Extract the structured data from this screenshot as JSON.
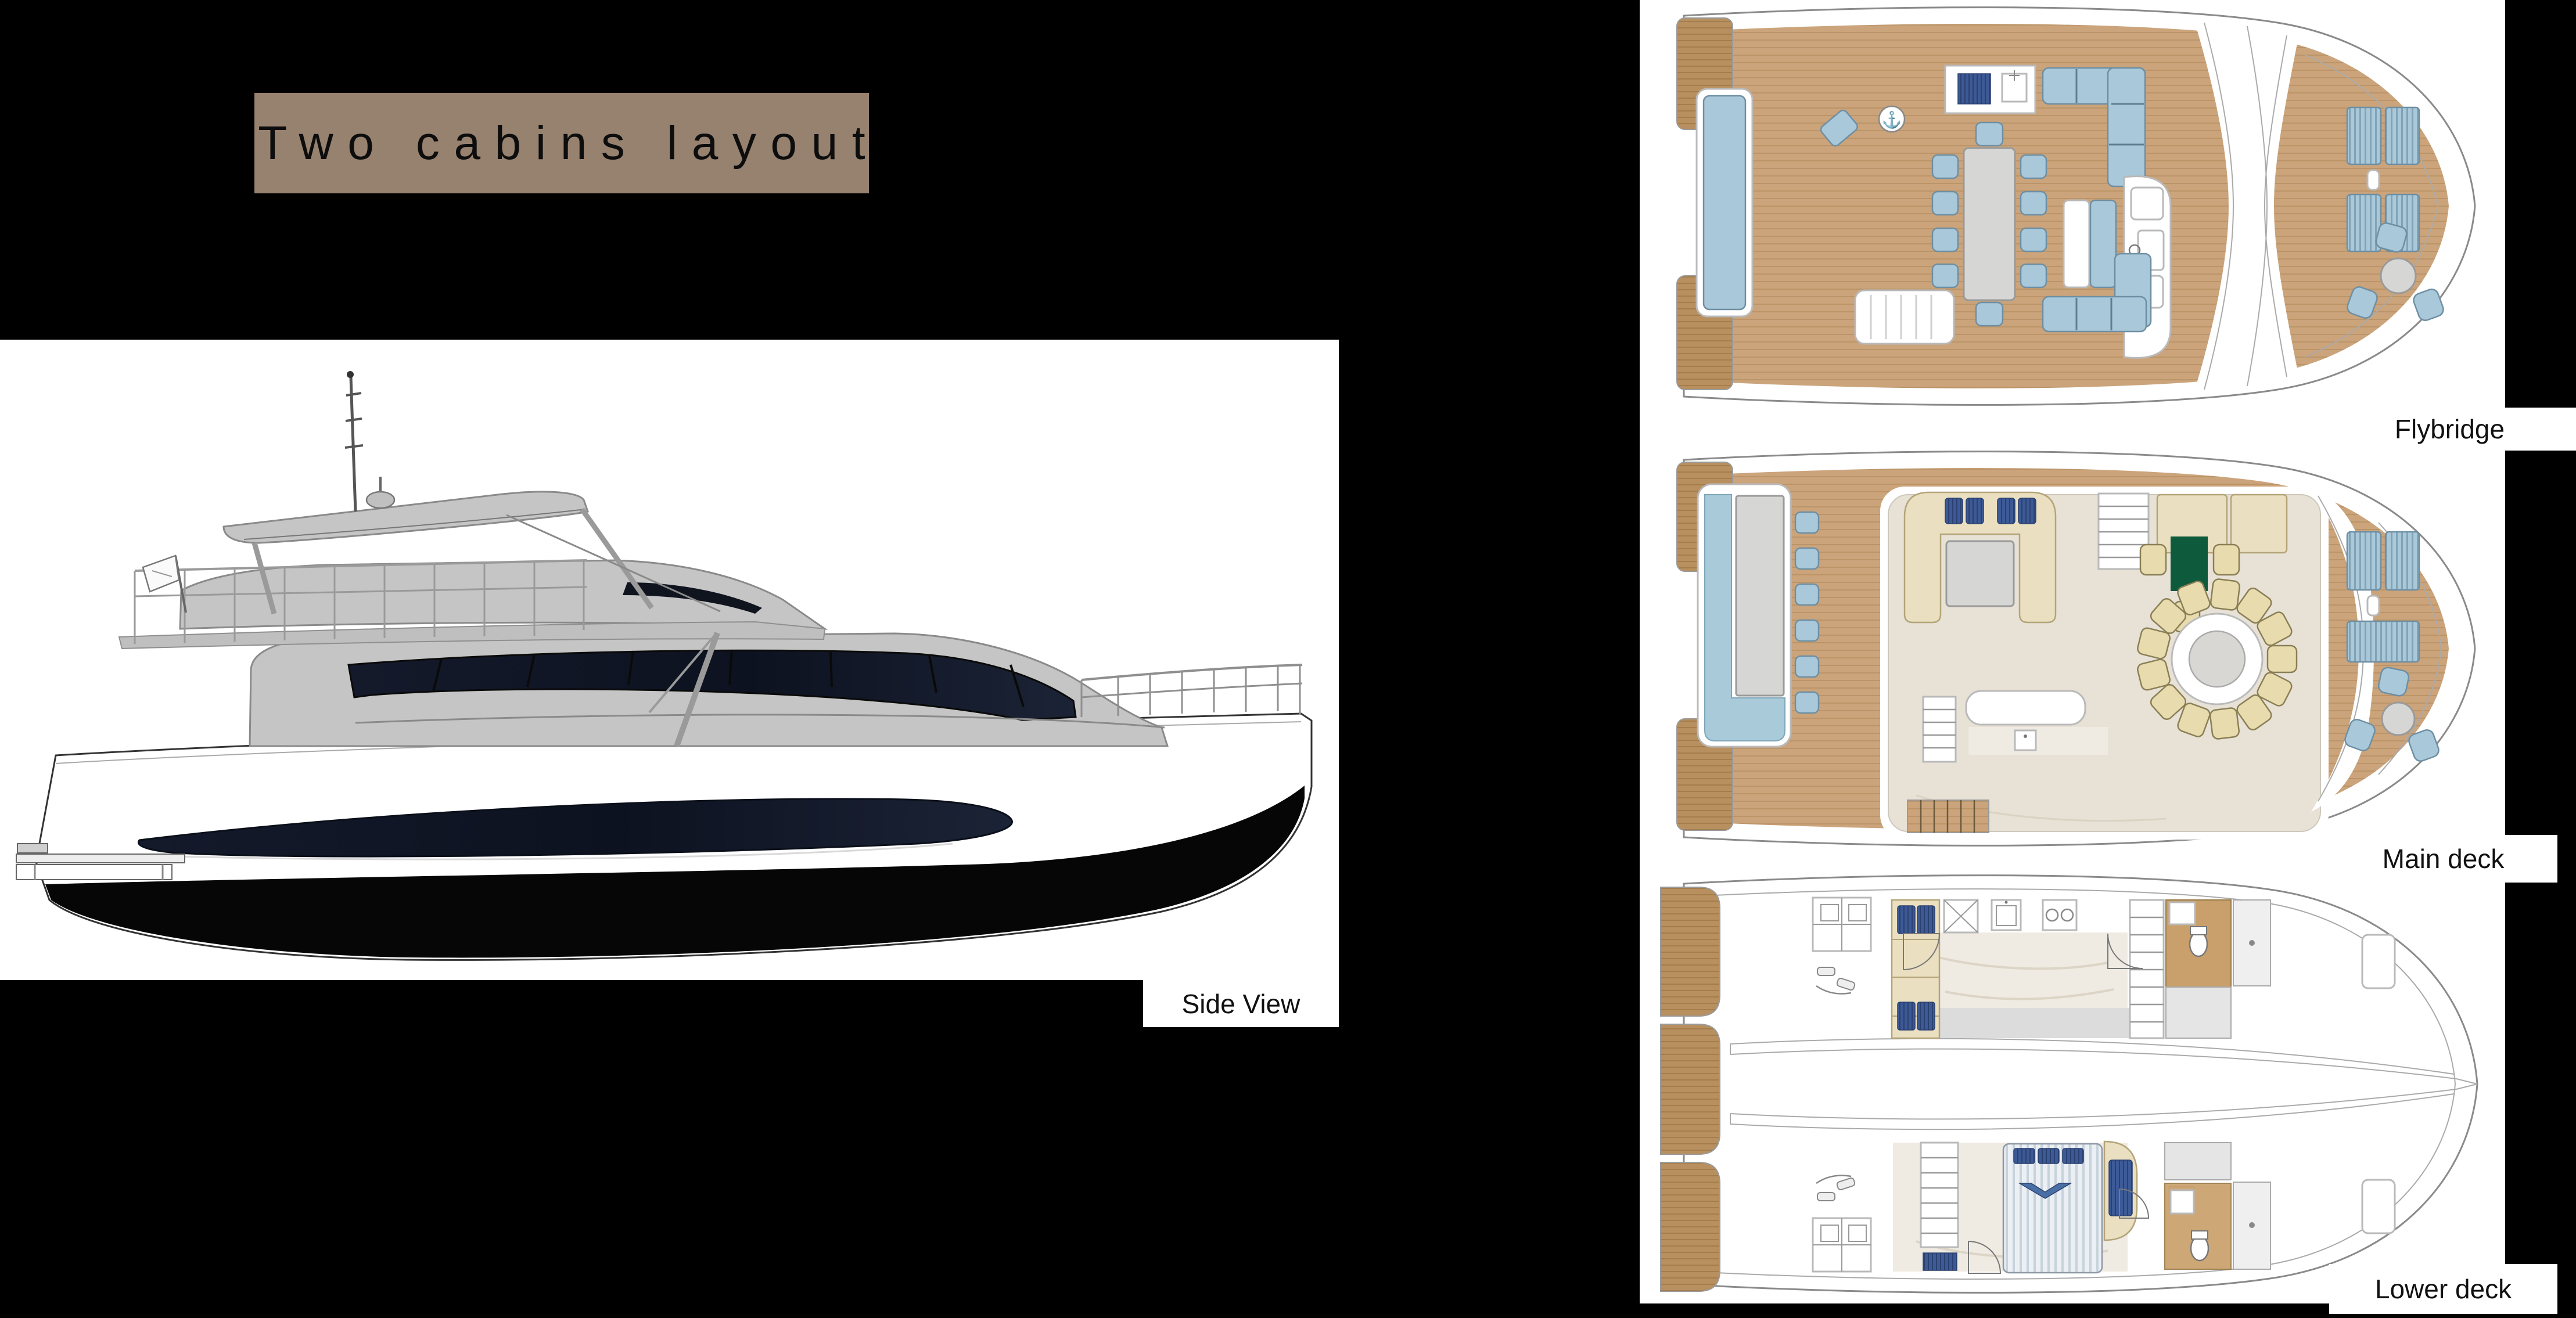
{
  "title": {
    "text": "Two cabins layout"
  },
  "side_view": {
    "label": "Side View"
  },
  "decks": [
    {
      "label": "Flybridge"
    },
    {
      "label": "Main deck"
    },
    {
      "label": "Lower deck"
    }
  ],
  "icons": {
    "anchor": "⚓"
  },
  "colors": {
    "page_bg": "#000000",
    "title_bg": "#97816F",
    "title_text": "#0D0D0D",
    "panel_bg": "#FFFFFF",
    "label_text": "#111111",
    "wood": "#CBA47B",
    "wood_line": "#A8834F",
    "wood_dark": "#B8905F",
    "wood_floor": "#C9A06B",
    "furniture_blue": "#A9C8D9",
    "furniture_blue_line": "#6E8FA3",
    "navy_pillow": "#3D5A96",
    "navy_pillow_line": "#2A4170",
    "cream": "#EADFC0",
    "cream_line": "#B3A478",
    "cream_chair": "#E8DBAE",
    "interior_floor": "#E7E1D6",
    "marble": "#EFEBE3",
    "gray_furniture": "#D6D6D4",
    "tv_green": "#0E5A3C",
    "pool_water": "#A9CBD9",
    "glass_dark": "#10141F",
    "superstructure_gray": "#C5C5C5",
    "outline_gray": "#8A8A8A",
    "hull_black": "#060606",
    "bed_base": "#ECF0F4",
    "bed_stripe": "#C7D3DC"
  }
}
